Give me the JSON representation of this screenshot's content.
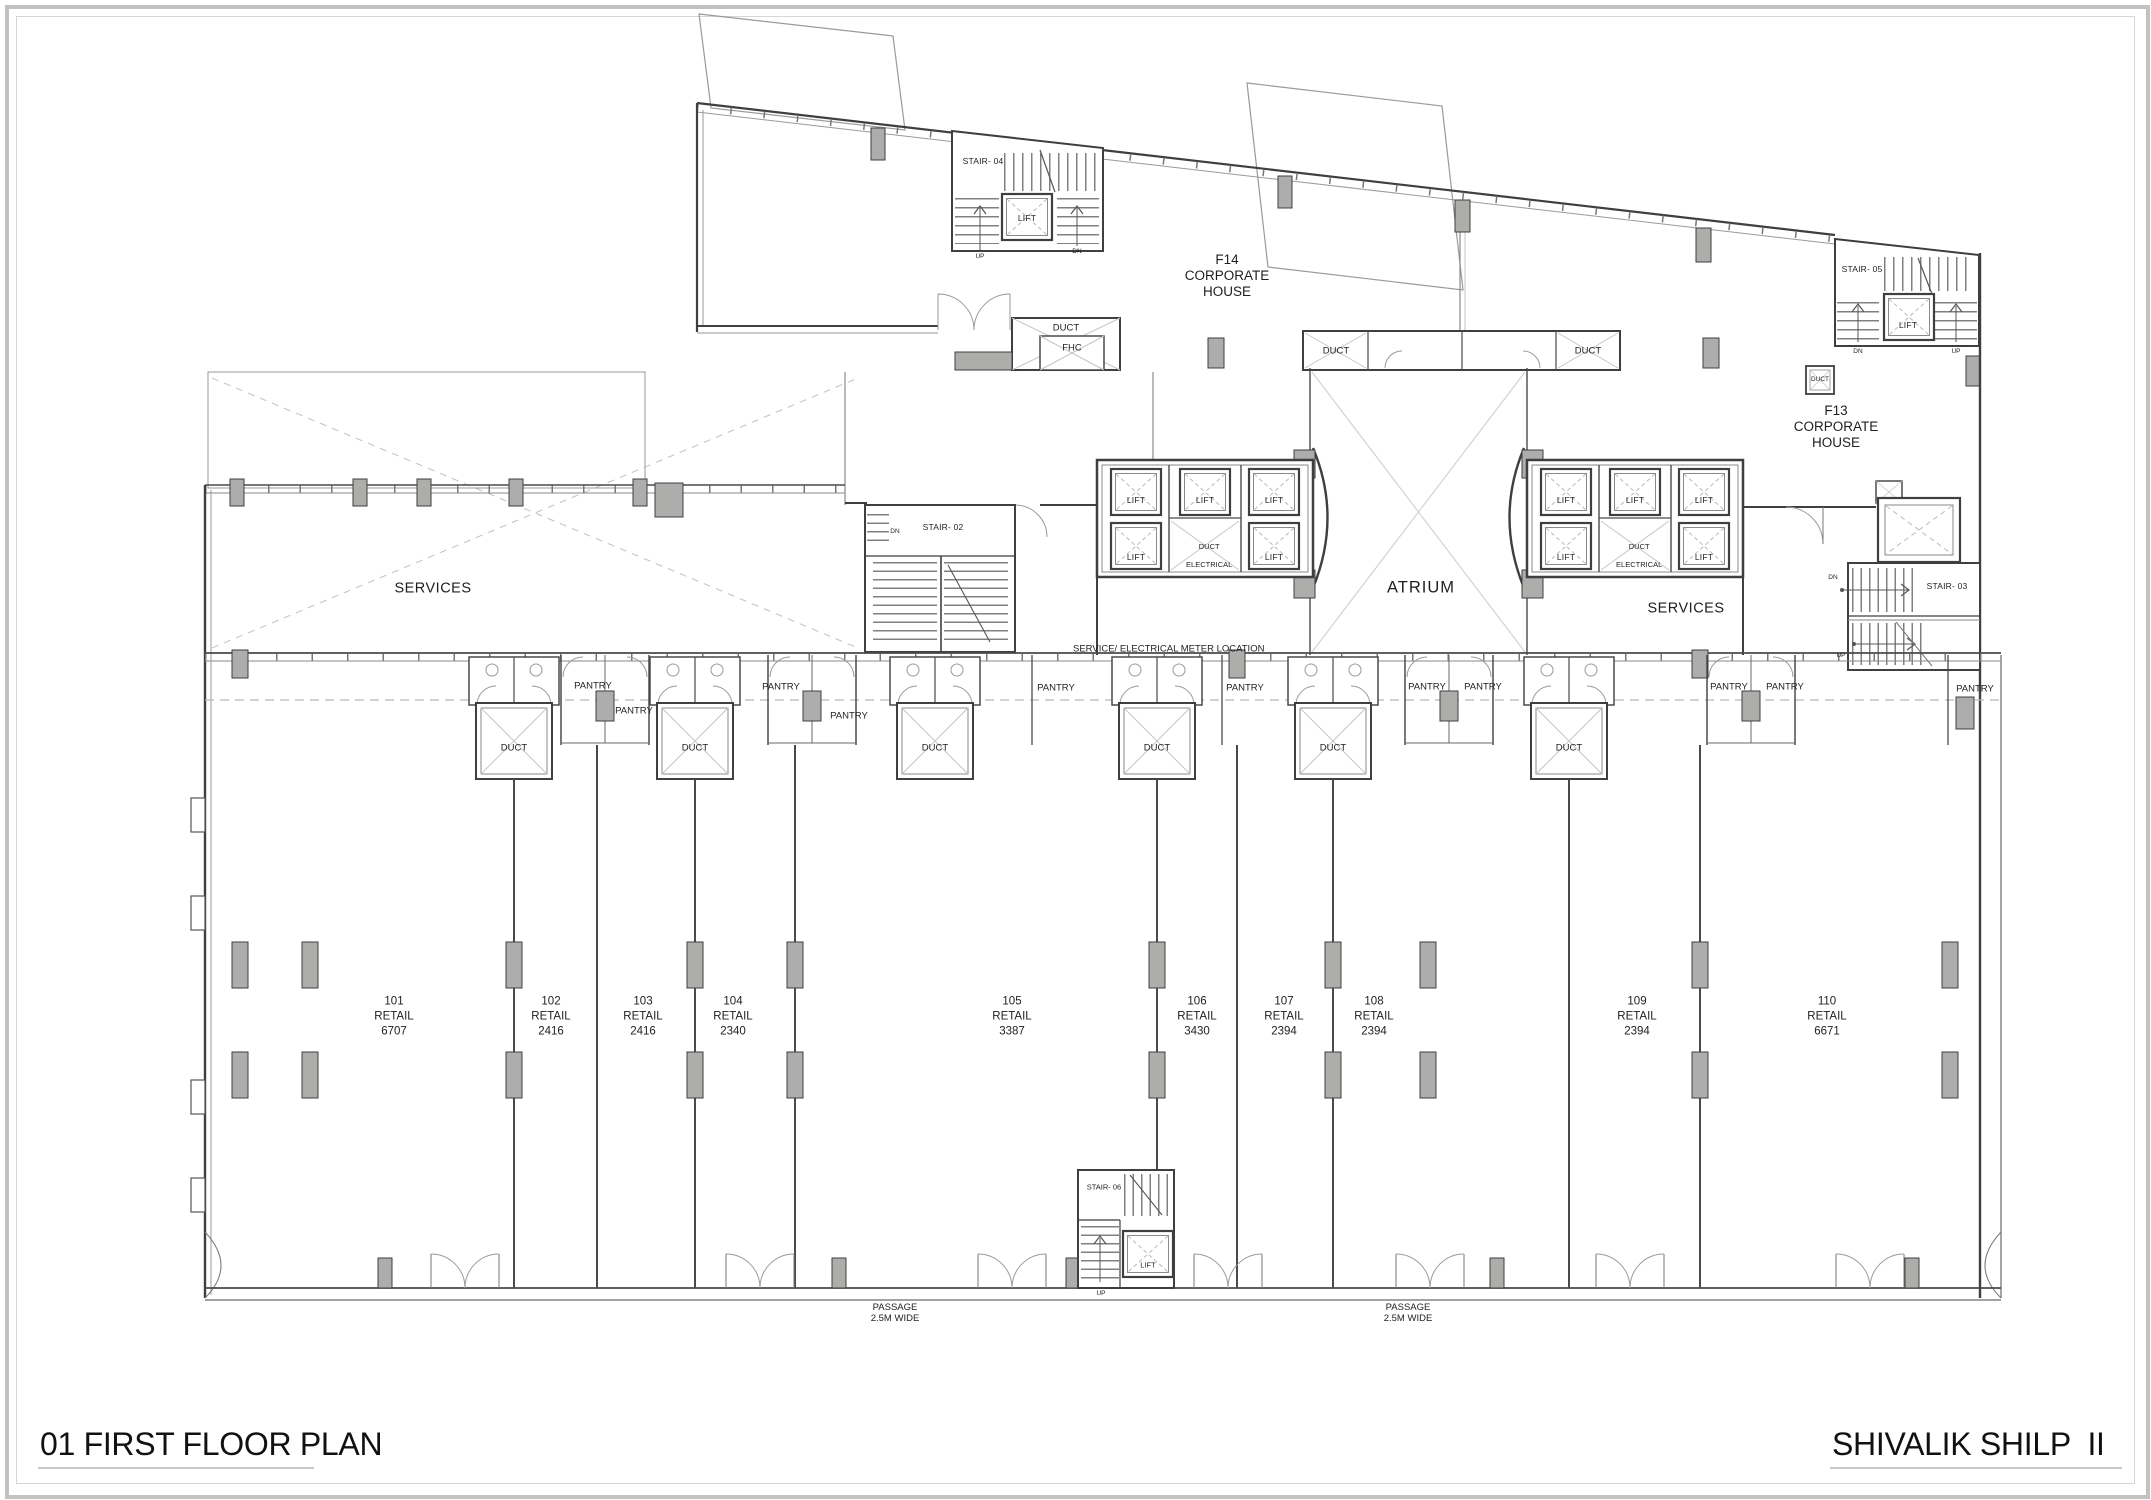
{
  "titles": {
    "plan": "01 FIRST FLOOR PLAN",
    "project": "SHIVALIK SHILP  II"
  },
  "units": [
    {
      "id": "101",
      "use": "RETAIL",
      "area": "6707"
    },
    {
      "id": "102",
      "use": "RETAIL",
      "area": "2416"
    },
    {
      "id": "103",
      "use": "RETAIL",
      "area": "2416"
    },
    {
      "id": "104",
      "use": "RETAIL",
      "area": "2340"
    },
    {
      "id": "105",
      "use": "RETAIL",
      "area": "3387"
    },
    {
      "id": "106",
      "use": "RETAIL",
      "area": "3430"
    },
    {
      "id": "107",
      "use": "RETAIL",
      "area": "2394"
    },
    {
      "id": "108",
      "use": "RETAIL",
      "area": "2394"
    },
    {
      "id": "109",
      "use": "RETAIL",
      "area": "2394"
    },
    {
      "id": "110",
      "use": "RETAIL",
      "area": "6671"
    }
  ],
  "corporate": [
    {
      "id": "F14",
      "l1": "CORPORATE",
      "l2": "HOUSE"
    },
    {
      "id": "F13",
      "l1": "CORPORATE",
      "l2": "HOUSE"
    }
  ],
  "stairs": {
    "s02": "STAIR- 02",
    "s03": "STAIR- 03",
    "s04": "STAIR- 04",
    "s05": "STAIR- 05",
    "s06": "STAIR- 06"
  },
  "core": {
    "lift": "LIFT",
    "duct": "DUCT",
    "duct_electrical_l1": "DUCT",
    "duct_electrical_l2": "ELECTRICAL",
    "pantry": "PANTRY",
    "fhc": "FHC",
    "atrium": "ATRIUM",
    "services": "SERVICES",
    "up": "UP",
    "dn": "DN"
  },
  "notes": {
    "meter": "SERVICE/ ELECTRICAL METER LOCATION",
    "passage_l1": "PASSAGE",
    "passage_l2": "2.5M WIDE"
  },
  "colors": {
    "wall": "#3f3f3f",
    "thin": "#8a8a8a",
    "light": "#c6c6c4",
    "column_fill": "#adadab",
    "frame": "#c2c2c0",
    "text": "#1f1f1f"
  }
}
